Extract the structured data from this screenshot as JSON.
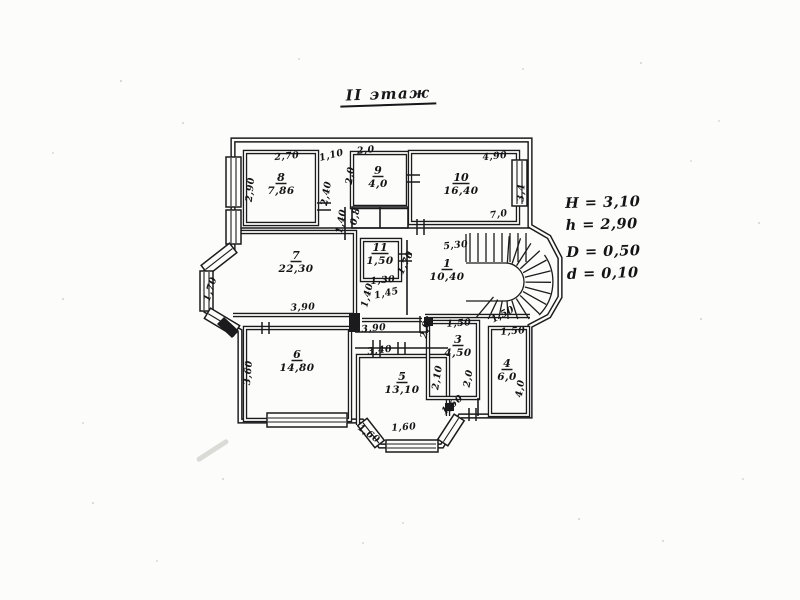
{
  "title": "II этаж",
  "side_annotations": [
    "H = 3,10",
    "h = 2,90",
    "D = 0,50",
    "d = 0,10"
  ],
  "colors": {
    "ink": "#1b1b1d",
    "paper": "#fcfcfa"
  },
  "plan": {
    "rooms": [
      {
        "num": "8",
        "area": "7,86",
        "x": 281,
        "y": 181
      },
      {
        "num": "9",
        "area": "4,0",
        "x": 378,
        "y": 174
      },
      {
        "num": "10",
        "area": "16,40",
        "x": 461,
        "y": 181
      },
      {
        "num": "7",
        "area": "22,30",
        "x": 296,
        "y": 259
      },
      {
        "num": "11",
        "area": "1,50",
        "x": 380,
        "y": 251
      },
      {
        "num": "1",
        "area": "10,40",
        "x": 447,
        "y": 267
      },
      {
        "num": "6",
        "area": "14,80",
        "x": 297,
        "y": 358
      },
      {
        "num": "5",
        "area": "13,10",
        "x": 402,
        "y": 380
      },
      {
        "num": "3",
        "area": "4,50",
        "x": 458,
        "y": 343
      },
      {
        "num": "4",
        "area": "6,0",
        "x": 507,
        "y": 367
      }
    ],
    "dims": [
      {
        "t": "2,70",
        "x": 287,
        "y": 159,
        "r": -5
      },
      {
        "t": "2,90",
        "x": 253,
        "y": 190,
        "r": -84
      },
      {
        "t": "1,10",
        "x": 332,
        "y": 158,
        "r": -14
      },
      {
        "t": "2,40",
        "x": 329,
        "y": 194,
        "r": -80
      },
      {
        "t": "1,40",
        "x": 344,
        "y": 222,
        "r": -80
      },
      {
        "t": "2,0",
        "x": 366,
        "y": 153,
        "r": -6
      },
      {
        "t": "2,0",
        "x": 353,
        "y": 176,
        "r": -82
      },
      {
        "t": "0,8",
        "x": 358,
        "y": 217,
        "r": -78
      },
      {
        "t": "4,90",
        "x": 495,
        "y": 159,
        "r": -6
      },
      {
        "t": "3,4",
        "x": 524,
        "y": 193,
        "r": -86
      },
      {
        "t": "7,0",
        "x": 499,
        "y": 217,
        "r": -8
      },
      {
        "t": "5,30",
        "x": 456,
        "y": 248,
        "r": -6
      },
      {
        "t": "1,70",
        "x": 408,
        "y": 264,
        "r": -64
      },
      {
        "t": "1,30",
        "x": 383,
        "y": 283,
        "r": -5
      },
      {
        "t": "1,45",
        "x": 387,
        "y": 296,
        "r": -12
      },
      {
        "t": "1,40",
        "x": 370,
        "y": 296,
        "r": -76
      },
      {
        "t": "3,90",
        "x": 303,
        "y": 310,
        "r": -3
      },
      {
        "t": "1,70",
        "x": 213,
        "y": 290,
        "r": -73
      },
      {
        "t": "3,60",
        "x": 251,
        "y": 373,
        "r": -85
      },
      {
        "t": "3,90",
        "x": 374,
        "y": 331,
        "r": -5
      },
      {
        "t": "3,40",
        "x": 380,
        "y": 353,
        "r": -7
      },
      {
        "t": "2,0",
        "x": 428,
        "y": 330,
        "r": -80
      },
      {
        "t": "1,50",
        "x": 459,
        "y": 326,
        "r": -4
      },
      {
        "t": "2,10",
        "x": 440,
        "y": 378,
        "r": -81
      },
      {
        "t": "2,0",
        "x": 471,
        "y": 379,
        "r": -80
      },
      {
        "t": "1,50",
        "x": 504,
        "y": 317,
        "r": -28
      },
      {
        "t": "1,50",
        "x": 513,
        "y": 334,
        "r": -4
      },
      {
        "t": "4,0",
        "x": 523,
        "y": 389,
        "r": -82
      },
      {
        "t": "1,60",
        "x": 454,
        "y": 407,
        "r": -40
      },
      {
        "t": "1,60",
        "x": 404,
        "y": 430,
        "r": -4
      },
      {
        "t": "1,60",
        "x": 367,
        "y": 436,
        "r": 36
      }
    ]
  }
}
